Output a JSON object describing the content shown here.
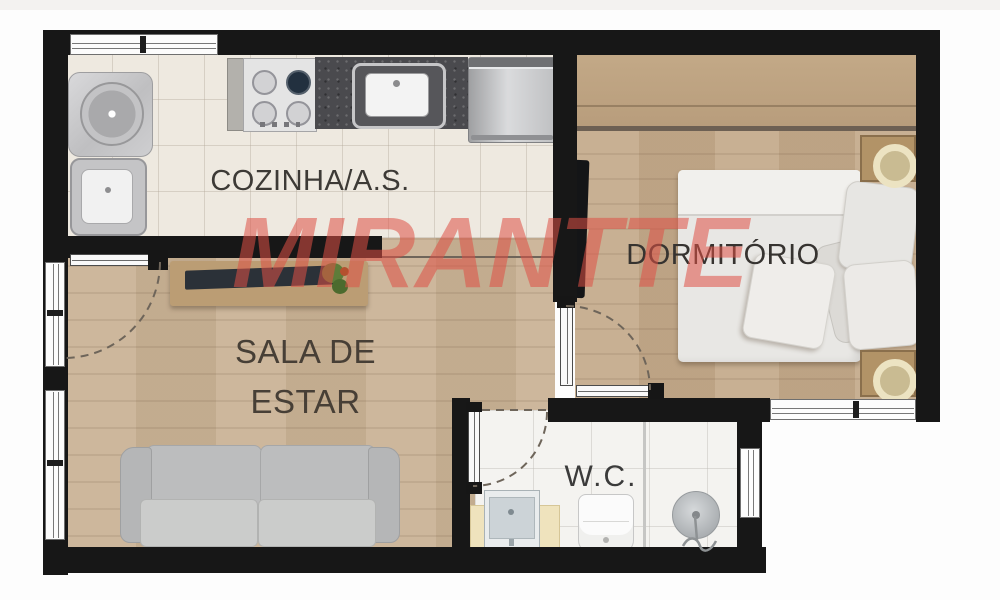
{
  "watermark": {
    "text": "MIRANTTE",
    "color": "#de5047"
  },
  "rooms": {
    "kitchen": {
      "label": "COZINHA/A.S."
    },
    "bedroom": {
      "label": "DORMITÓRIO"
    },
    "living_room": {
      "label_line1": "SALA DE",
      "label_line2": "ESTAR"
    },
    "bathroom": {
      "label": "W.C."
    }
  },
  "palette": {
    "wall": "#171717",
    "wood_floor_living": "#c9b295",
    "wood_floor_bedroom": "#c4aa8b",
    "kitchen_tile": "#eee9e0",
    "bathroom_tile": "#f4f3f0",
    "granite_counter": "#4b4b4f",
    "label_text": "#3d3a36",
    "watermark_red": "#de5047"
  }
}
